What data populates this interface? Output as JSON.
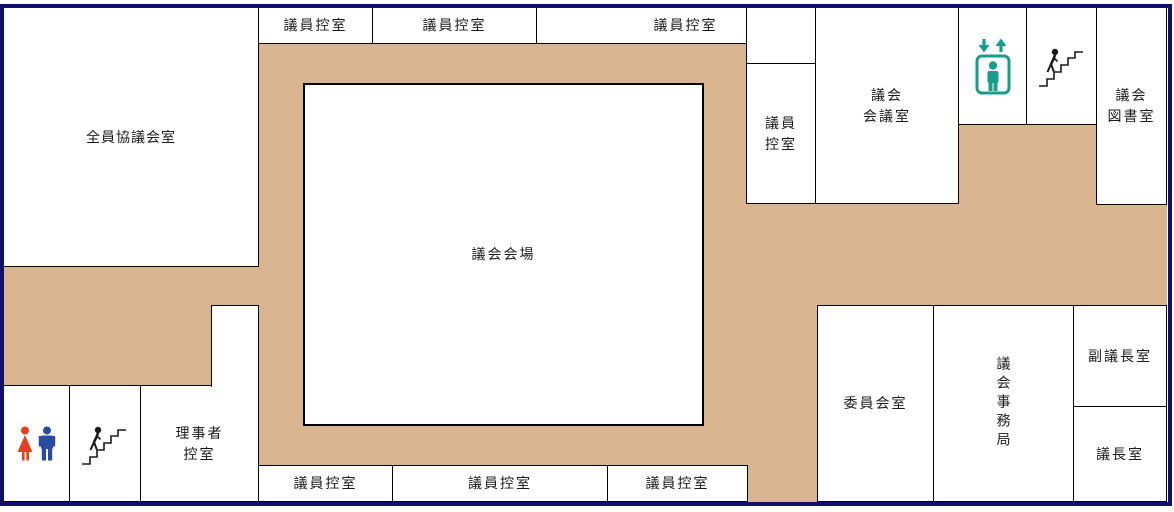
{
  "colors": {
    "corridor": "#d8b58e",
    "frame": "#10106b",
    "room_border": "#000000",
    "elevator": "#199d8b",
    "restroom_female": "#e2421f",
    "restroom_male": "#2b4aa1",
    "label_text": "#1a1a1a"
  },
  "labels": {
    "all_members_meeting_room": "全員協議会室",
    "member_waiting_room": "議員控室",
    "member_waiting_room_l1": "議員",
    "member_waiting_room_l2": "控室",
    "assembly_hall": "議会会場",
    "council_meeting_room_l1": "議会",
    "council_meeting_room_l2": "会議室",
    "council_library_l1": "議会",
    "council_library_l2": "図書室",
    "committee_room": "委員会室",
    "council_secretariat": "議会事務局",
    "vice_speaker_room": "副議長室",
    "speaker_room": "議長室",
    "executives_waiting_room_l1": "理事者",
    "executives_waiting_room_l2": "控室"
  },
  "icons": {
    "elevator": "elevator-icon",
    "stairs_north": "stairs-icon",
    "stairs_south": "stairs-icon",
    "restroom": "restroom-icon"
  }
}
